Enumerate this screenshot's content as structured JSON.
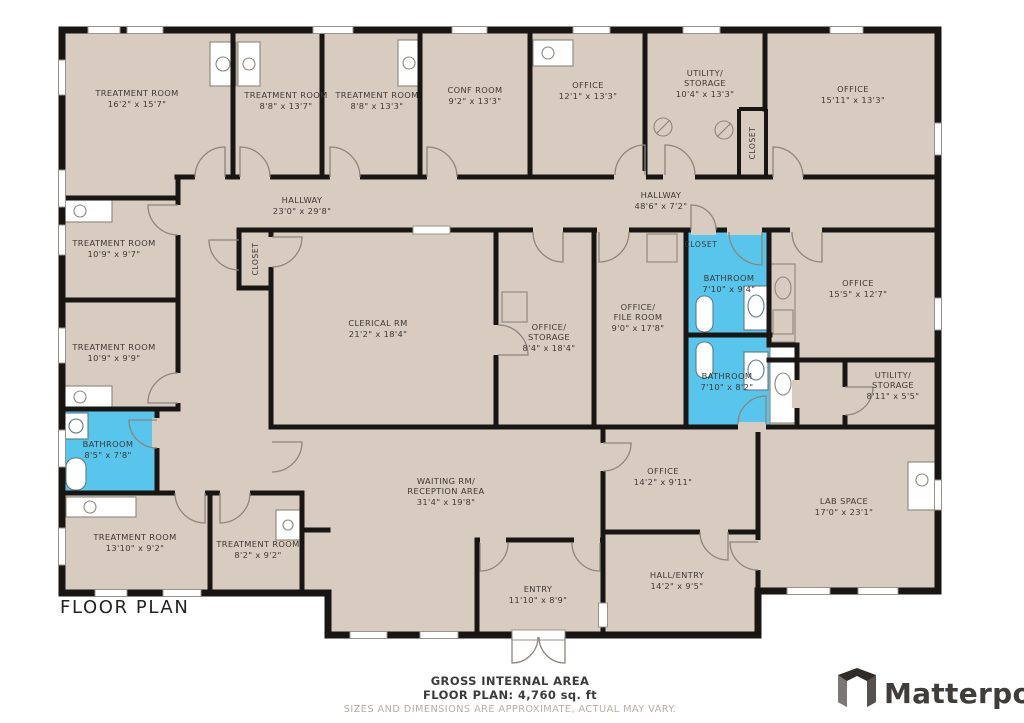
{
  "title": "FLOOR PLAN",
  "rooms": [
    {
      "id": "treatment-room-1",
      "lines": [
        "TREATMENT ROOM",
        "16'2\" x 15'7\""
      ]
    },
    {
      "id": "treatment-room-2",
      "lines": [
        "TREATMENT ROOM",
        "8'8\" x 13'7\""
      ]
    },
    {
      "id": "treatment-room-3",
      "lines": [
        "TREATMENT ROOM",
        "8'8\" x 13'3\""
      ]
    },
    {
      "id": "conf-room",
      "lines": [
        "CONF ROOM",
        "9'2\" x 13'3\""
      ]
    },
    {
      "id": "office-top",
      "lines": [
        "OFFICE",
        "12'1\" x 13'3\""
      ]
    },
    {
      "id": "utility-storage-top",
      "lines": [
        "UTILITY/",
        "STORAGE",
        "10'4\" x 13'3\""
      ]
    },
    {
      "id": "office-top-right",
      "lines": [
        "OFFICE",
        "15'11\" x 13'3\""
      ]
    },
    {
      "id": "hallway-west",
      "lines": [
        "HALLWAY",
        "23'0\" x 29'8\""
      ]
    },
    {
      "id": "hallway-east",
      "lines": [
        "HALLWAY",
        "48'6\" x 7'2\""
      ]
    },
    {
      "id": "treatment-room-4",
      "lines": [
        "TREATMENT ROOM",
        "10'9\" x 9'7\""
      ]
    },
    {
      "id": "treatment-room-5",
      "lines": [
        "TREATMENT ROOM",
        "10'9\" x 9'9\""
      ]
    },
    {
      "id": "clerical-room",
      "lines": [
        "CLERICAL RM",
        "21'2\" x 18'4\""
      ]
    },
    {
      "id": "office-storage",
      "lines": [
        "OFFICE/",
        "STORAGE",
        "8'4\" x 18'4\""
      ]
    },
    {
      "id": "office-file-room",
      "lines": [
        "OFFICE/",
        "FILE ROOM",
        "9'0\" x 17'8\""
      ]
    },
    {
      "id": "bathroom-1",
      "lines": [
        "BATHROOM",
        "7'10\" x 9'4\""
      ]
    },
    {
      "id": "bathroom-2",
      "lines": [
        "BATHROOM",
        "7'10\" x 8'2\""
      ]
    },
    {
      "id": "office-mid-right",
      "lines": [
        "OFFICE",
        "15'5\" x 12'7\""
      ]
    },
    {
      "id": "utility-storage-right",
      "lines": [
        "UTILITY/",
        "STORAGE",
        "8'11\" x 5'5\""
      ]
    },
    {
      "id": "bathroom-3",
      "lines": [
        "BATHROOM",
        "8'5\" x 7'8\""
      ]
    },
    {
      "id": "treatment-room-6",
      "lines": [
        "TREATMENT ROOM",
        "13'10\" x 9'2\""
      ]
    },
    {
      "id": "treatment-room-7",
      "lines": [
        "TREATMENT ROOM",
        "8'2\" x 9'2\""
      ]
    },
    {
      "id": "waiting-reception",
      "lines": [
        "WAITING RM/",
        "RECEPTION AREA",
        "31'4\" x 19'8\""
      ]
    },
    {
      "id": "entry",
      "lines": [
        "ENTRY",
        "11'10\" x 8'9\""
      ]
    },
    {
      "id": "hall-entry",
      "lines": [
        "HALL/ENTRY",
        "14'2\" x 9'5\""
      ]
    },
    {
      "id": "office-bottom",
      "lines": [
        "OFFICE",
        "14'2\" x 9'11\""
      ]
    },
    {
      "id": "lab-space",
      "lines": [
        "LAB SPACE",
        "17'0\" x 23'1\""
      ]
    }
  ],
  "closets": [
    "CLOSET",
    "CLOSET",
    "CLOSET"
  ],
  "footer": {
    "gross": "GROSS INTERNAL AREA",
    "plan": "FLOOR PLAN: 4,760 sq. ft",
    "disclaimer": "SIZES AND DIMENSIONS ARE APPROXIMATE, ACTUAL MAY VARY."
  },
  "brand": {
    "name": "Matterport"
  },
  "colors": {
    "floor": "#D8CCC1",
    "wall": "#181512",
    "bathroom_highlight": "#58C5EC",
    "label_text": "#3E3833",
    "disclaimer_text": "#B5AEA6"
  }
}
